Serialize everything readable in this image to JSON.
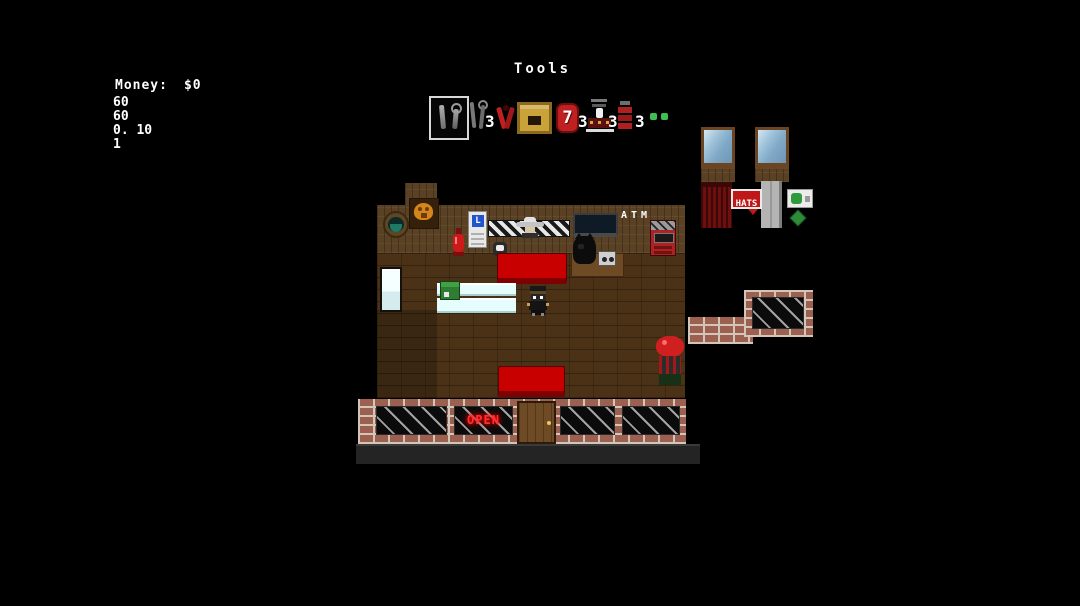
{
  "hud": {
    "money_label": "Money:",
    "money_value": "$0",
    "stats": [
      "60",
      "60",
      "0. 10",
      "1"
    ]
  },
  "toolbar": {
    "title": "Tools",
    "slots": [
      {
        "name": "wrench-screwdriver-selected",
        "count": ""
      },
      {
        "name": "wrench-screwdriver",
        "count": "3"
      },
      {
        "name": "red-pliers",
        "count": ""
      },
      {
        "name": "crate",
        "count": ""
      },
      {
        "name": "seven-chip",
        "glyph": "7",
        "count": "3"
      },
      {
        "name": "arcade-machine",
        "count": "3"
      },
      {
        "name": "red-shelf",
        "count": "3"
      },
      {
        "name": "green-dots",
        "count": ""
      }
    ]
  },
  "scene": {
    "signs": {
      "atm": "ATM",
      "hats": "HATS",
      "open": "OPEN"
    },
    "fridge_glyph": "L",
    "colors": {
      "background": "#000000",
      "wood_wall": "#5a4124",
      "wood_floor": "#4b3217",
      "brick": "#9c6050",
      "counter_cyan": "#e6fdfd",
      "couch_red": "#c80000",
      "neon_red": "#ff3030",
      "sign_red": "#c01818",
      "window_blue": "#7fa9c6",
      "hud_text": "#ffffff"
    }
  }
}
